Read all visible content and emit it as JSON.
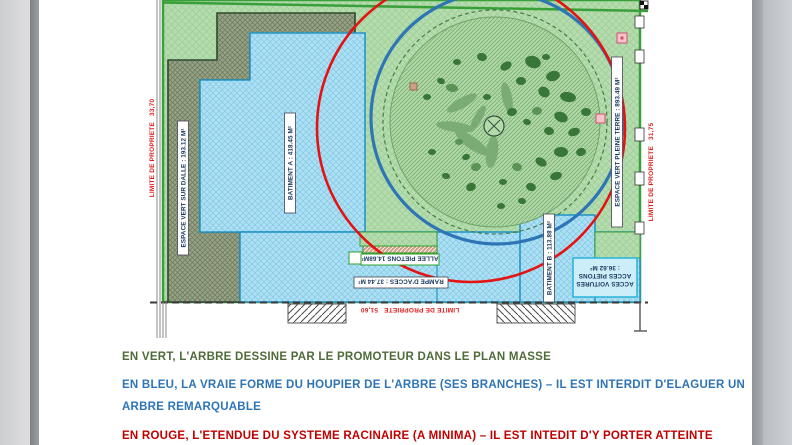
{
  "page": {
    "plan": {
      "labels": {
        "limite_left": "LIMITE DE PROPRIETE   33,70",
        "limite_right": "LIMITE DE PROPRIETE   31,75",
        "limite_bottom": "LIMITE DE PROPRIETE   51,60",
        "espace_vert_sur_dalle": "ESPACE VERT SUR DALLE : 193.12 M²",
        "batiment_a": "BATIMENT A : 418.45 M²",
        "espace_vert_pleine_terre": "ESPACE VERT PLEINE TERRE : 893.49 M²",
        "batiment_b": "BATIMENT B : 113.88 M²",
        "allee_pietons": "ALLEE PIETONS 14.68M²",
        "rampe_acces": "RAMPE D'ACCES : 37.44 M²",
        "acces_line1": "ACCES VOITURES",
        "acces_line2": "ACCES PIETONS",
        "acces_line3": ": 36.62 M²"
      },
      "colors": {
        "espace_vert_fill": "#b5dcae",
        "espace_vert_sur_dalle_fill": "#95a286",
        "batiment_fill": "#aee0f4",
        "houppier_circle_blue": "#2e75b6",
        "racinaire_circle_red": "#e51212",
        "limite_text_red": "#e02020"
      }
    },
    "annotations": [
      {
        "id": "en-vert",
        "color": "#4e6b3a",
        "text": "EN VERT, L'ARBRE DESSINE PAR LE PROMOTEUR DANS LE PLAN MASSE"
      },
      {
        "id": "en-bleu-1",
        "color": "#2e74b5",
        "text": "EN BLEU, LA VRAIE FORME DU HOUPIER DE L'ARBRE (SES BRANCHES) – IL EST INTERDIT D'ELAGUER UN"
      },
      {
        "id": "en-bleu-2",
        "color": "#2e74b5",
        "text": "ARBRE REMARQUABLE"
      },
      {
        "id": "en-rouge",
        "color": "#c00000",
        "text": "EN ROUGE, L'ETENDUE DU SYSTEME RACINAIRE (A MINIMA) – IL EST INTEDIT D'Y PORTER ATTEINTE"
      }
    ]
  }
}
